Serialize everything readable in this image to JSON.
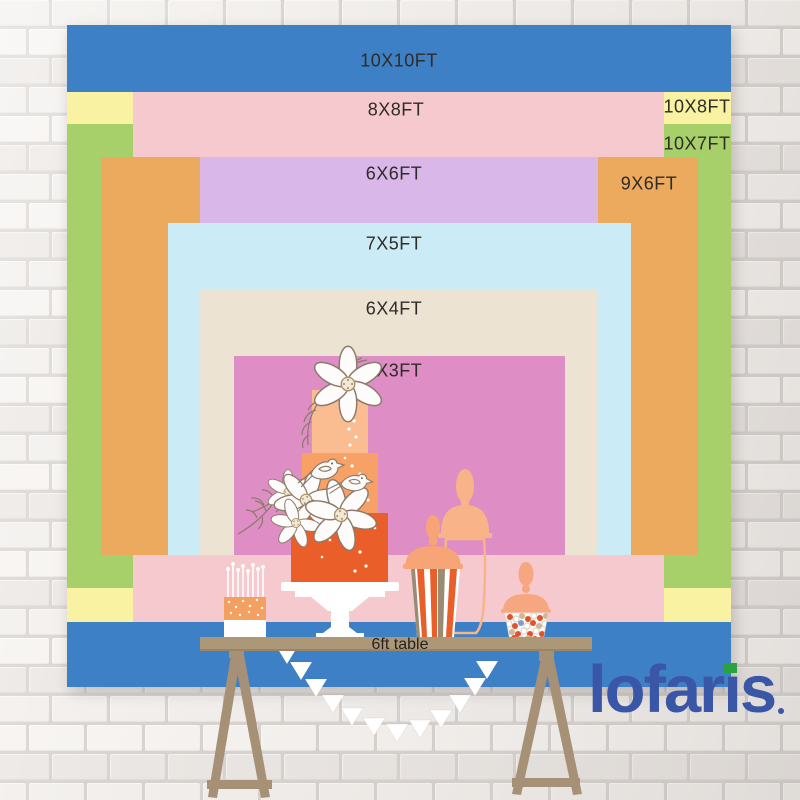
{
  "backdrop": {
    "sizes": [
      {
        "id": "10x10",
        "label": "10X10FT",
        "w_ft": 10,
        "h_ft": 10,
        "color": "#3e80c6"
      },
      {
        "id": "10x8",
        "label": "10X8FT",
        "w_ft": 10,
        "h_ft": 8,
        "color": "#f8f2a2"
      },
      {
        "id": "10x7",
        "label": "10X7FT",
        "w_ft": 10,
        "h_ft": 7,
        "color": "#a8d06a"
      },
      {
        "id": "8x8",
        "label": "8X8FT",
        "w_ft": 8,
        "h_ft": 8,
        "color": "#f5c9ce"
      },
      {
        "id": "9x6",
        "label": "9X6FT",
        "w_ft": 9,
        "h_ft": 6,
        "color": "#ecaa5f"
      },
      {
        "id": "6x6",
        "label": "6X6FT",
        "w_ft": 6,
        "h_ft": 6,
        "color": "#dab7e9"
      },
      {
        "id": "7x5",
        "label": "7X5FT",
        "w_ft": 7,
        "h_ft": 5,
        "color": "#cbecf7"
      },
      {
        "id": "6x4",
        "label": "6X4FT",
        "w_ft": 6,
        "h_ft": 4,
        "color": "#ece3d2"
      },
      {
        "id": "5x3",
        "label": "5X3FT",
        "w_ft": 5,
        "h_ft": 3,
        "color": "#de8ec4"
      }
    ],
    "label_color": "#2f2b27",
    "table_label": "6ft table"
  },
  "brand": {
    "name": "lofaris",
    "parts": [
      "lofar",
      "ı",
      "s"
    ],
    "color": "#3a56a6",
    "dot_color": "#28a33f"
  },
  "scene": {
    "icons": [
      "tiered-cake-icon",
      "candle-cake-icon",
      "popcorn-jar-icon",
      "candy-jar-icon",
      "apothecary-jar-icon",
      "bunting-icon",
      "trestle-table",
      "flower-icon",
      "bird-icon"
    ],
    "colors": {
      "cake_top": "#fabd92",
      "cake_mid": "#f7a166",
      "cake_bottom": "#e95e29",
      "table": "#ac9779",
      "jar_peach": "#f7a477",
      "stripe_orange": "#e85f2b",
      "stripe_gray": "#9a8b73",
      "candy_tan": "#cdb795"
    }
  },
  "wall": {
    "brick_light": "#f6f3f0",
    "brick_mid": "#f2efec",
    "brick_dark": "#ebe7e4",
    "mortar": "#d9d4d0"
  }
}
